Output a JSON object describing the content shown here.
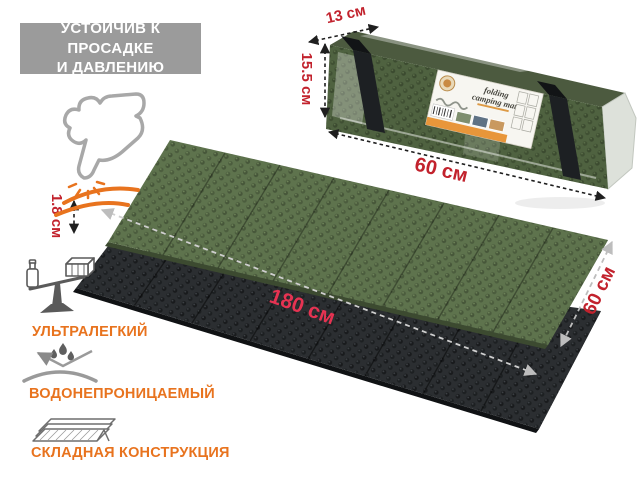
{
  "badge": {
    "line1": "УСТОЙЧИВ К ПРОСАДКЕ",
    "line2": "И ДАВЛЕНИЮ"
  },
  "package": {
    "label_line1": "folding",
    "label_line2": "camping mat",
    "dims": {
      "depth": "13 см",
      "height": "15.5 см",
      "length": "60 см"
    }
  },
  "mats": {
    "dims": {
      "thickness": "1.8 см",
      "length": "180 см",
      "width": "60 см"
    }
  },
  "features": [
    {
      "icon": "scale-balance-icon",
      "label": "УЛЬТРАЛЕГКИЙ"
    },
    {
      "icon": "water-repel-icon",
      "label": "ВОДОНЕПРОНИЦАЕМЫЙ"
    },
    {
      "icon": "accordion-fold-icon",
      "label": "СКЛАДНАЯ КОНСТРУКЦИЯ"
    }
  ],
  "colors": {
    "accent_red": "#c2222d",
    "accent_red_bright": "#e63352",
    "accent_orange": "#e8731e",
    "badge_gray": "#9b9b9b",
    "mat_green": "#5e734d",
    "mat_black": "#2b2e31"
  }
}
